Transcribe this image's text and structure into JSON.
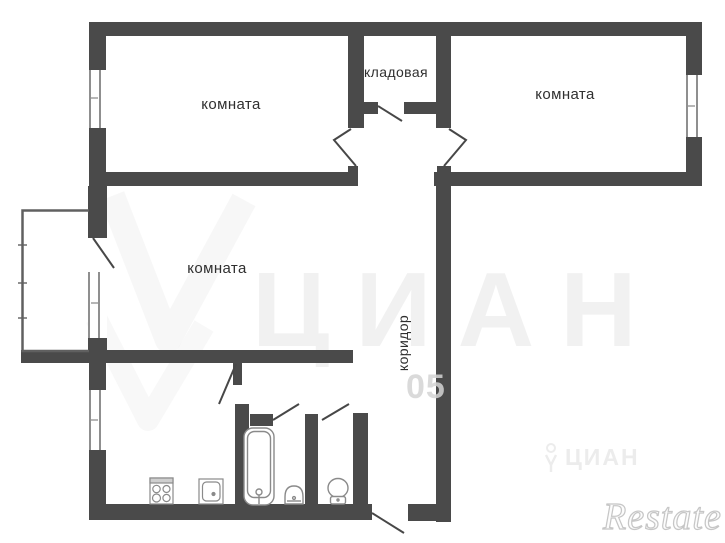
{
  "plan": {
    "labels": {
      "room_top_left": "комната",
      "pantry": "кладовая",
      "room_top_right": "комната",
      "room_middle": "комната",
      "corridor": "коридор"
    },
    "watermarks": {
      "brand_large": "ЦИАН",
      "digits": "05",
      "brand_small": "ЦИАН",
      "agency": "Restate"
    },
    "fixtures": [
      "bathtub",
      "bathroom-sink",
      "toilet",
      "stove",
      "kitchen-sink"
    ],
    "colors": {
      "wall": "#4a4a4a",
      "door_line": "#474747",
      "window_line": "#8f8f8f",
      "fixture_line": "#8a8a8a",
      "label_text": "#2f2f2f",
      "background": "#ffffff"
    }
  }
}
